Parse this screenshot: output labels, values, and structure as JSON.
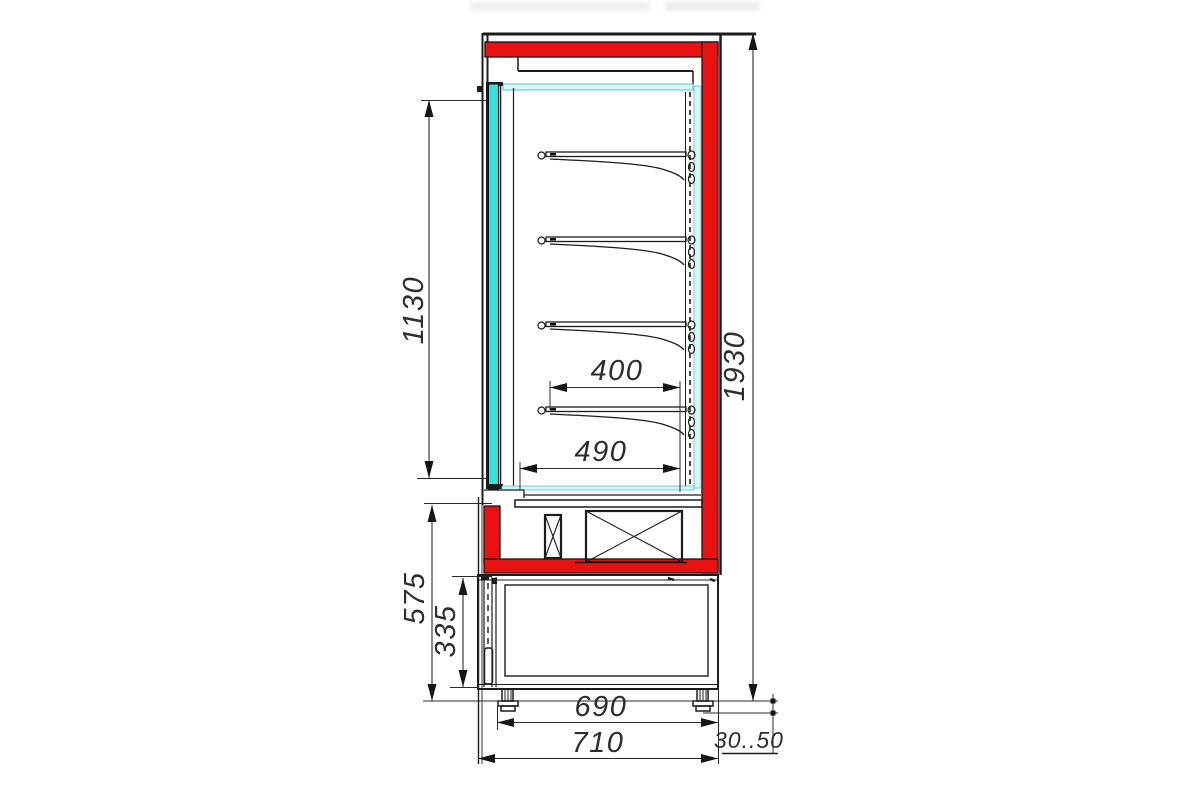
{
  "drawing": {
    "colors": {
      "red": "#e81212",
      "cyan": "#2ee4e0",
      "light_cyan": "#daf5f3",
      "line": "#1c1c1c",
      "text": "#2d2d2d"
    },
    "dims": {
      "opening_height": "1130",
      "overall_height": "1930",
      "shelf_depth": "400",
      "base_depth": "490",
      "lower_height": "575",
      "compartment_height": "335",
      "feet_span": "690",
      "overall_depth": "710",
      "foot_range": "30..50"
    }
  }
}
